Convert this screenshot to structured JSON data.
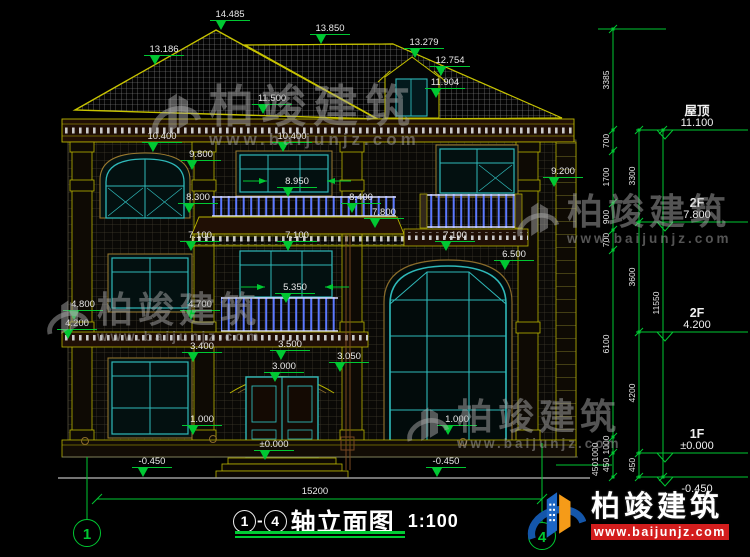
{
  "watermark": {
    "brand": "柏竣建筑",
    "url": "www.baijunjz.com"
  },
  "badge": {
    "brand": "柏竣建筑",
    "url": "www.baijunjz.com"
  },
  "bottom": {
    "overall": "15200",
    "axis_left": "1",
    "axis_right": "4",
    "title_start": "1",
    "title_sep": "-",
    "title_end": "4",
    "title": "轴立面图",
    "scale": "1:100"
  },
  "levels": [
    {
      "name": "屋顶",
      "value": "11.100",
      "y": 130
    },
    {
      "name": "2F",
      "value": "7.800",
      "y": 222
    },
    {
      "name": "2F",
      "value": "4.200",
      "y": 332
    },
    {
      "name": "1F",
      "value": "±0.000",
      "y": 453
    },
    {
      "name": "",
      "value": "-0.450",
      "y": 477,
      "below": true
    }
  ],
  "annotations": [
    {
      "t": "14.485",
      "x": 230,
      "y": 17
    },
    {
      "t": "13.850",
      "x": 330,
      "y": 31
    },
    {
      "t": "13.186",
      "x": 164,
      "y": 52
    },
    {
      "t": "13.279",
      "x": 424,
      "y": 45
    },
    {
      "t": "12.754",
      "x": 450,
      "y": 63
    },
    {
      "t": "11.904",
      "x": 445,
      "y": 85
    },
    {
      "t": "11.500",
      "x": 272,
      "y": 101
    },
    {
      "t": "10.400",
      "x": 162,
      "y": 139
    },
    {
      "t": "10.400",
      "x": 292,
      "y": 139
    },
    {
      "t": "9.800",
      "x": 201,
      "y": 157
    },
    {
      "t": "9.200",
      "x": 563,
      "y": 174
    },
    {
      "t": "8.950",
      "x": 297,
      "y": 184,
      "side": true
    },
    {
      "t": "8.300",
      "x": 198,
      "y": 200
    },
    {
      "t": "8.400",
      "x": 361,
      "y": 200
    },
    {
      "t": "7.800",
      "x": 384,
      "y": 215
    },
    {
      "t": "7.100",
      "x": 200,
      "y": 238
    },
    {
      "t": "7.100",
      "x": 297,
      "y": 238
    },
    {
      "t": "7.100",
      "x": 455,
      "y": 238
    },
    {
      "t": "6.500",
      "x": 514,
      "y": 257
    },
    {
      "t": "5.350",
      "x": 295,
      "y": 290,
      "side": true
    },
    {
      "t": "4.800",
      "x": 83,
      "y": 307
    },
    {
      "t": "4.200",
      "x": 77,
      "y": 326
    },
    {
      "t": "4.700",
      "x": 200,
      "y": 307
    },
    {
      "t": "3.400",
      "x": 202,
      "y": 349
    },
    {
      "t": "3.500",
      "x": 290,
      "y": 347
    },
    {
      "t": "3.050",
      "x": 349,
      "y": 359
    },
    {
      "t": "3.000",
      "x": 284,
      "y": 369
    },
    {
      "t": "1.000",
      "x": 202,
      "y": 422
    },
    {
      "t": "1.000",
      "x": 457,
      "y": 422
    },
    {
      "t": "±0.000",
      "x": 274,
      "y": 447
    },
    {
      "t": "-0.450",
      "x": 152,
      "y": 464
    },
    {
      "t": "-0.450",
      "x": 446,
      "y": 464
    }
  ],
  "dim_chains": [
    {
      "x": 613,
      "ticks": [
        29,
        130,
        151,
        203,
        230,
        250,
        437,
        453,
        477
      ],
      "labels": [
        {
          "t": "3385",
          "y": 80
        },
        {
          "t": "700",
          "y": 141
        },
        {
          "t": "1700",
          "y": 177
        },
        {
          "t": "900",
          "y": 217
        },
        {
          "t": "700",
          "y": 240
        },
        {
          "t": "6100",
          "y": 344
        },
        {
          "t": "1000",
          "y": 445
        },
        {
          "t": "450",
          "y": 465
        }
      ]
    },
    {
      "x": 639,
      "ticks": [
        130,
        222,
        332,
        453,
        477
      ],
      "labels": [
        {
          "t": "3300",
          "y": 176
        },
        {
          "t": "3600",
          "y": 277
        },
        {
          "t": "4200",
          "y": 393
        },
        {
          "t": "450",
          "y": 465
        }
      ]
    },
    {
      "x": 663,
      "ticks": [
        130,
        477
      ],
      "labels": [
        {
          "t": "11550",
          "y": 303
        }
      ]
    }
  ],
  "extra_dims": [
    {
      "t": "1000",
      "x": 598,
      "y": 452
    },
    {
      "t": "450",
      "x": 598,
      "y": 469
    }
  ]
}
